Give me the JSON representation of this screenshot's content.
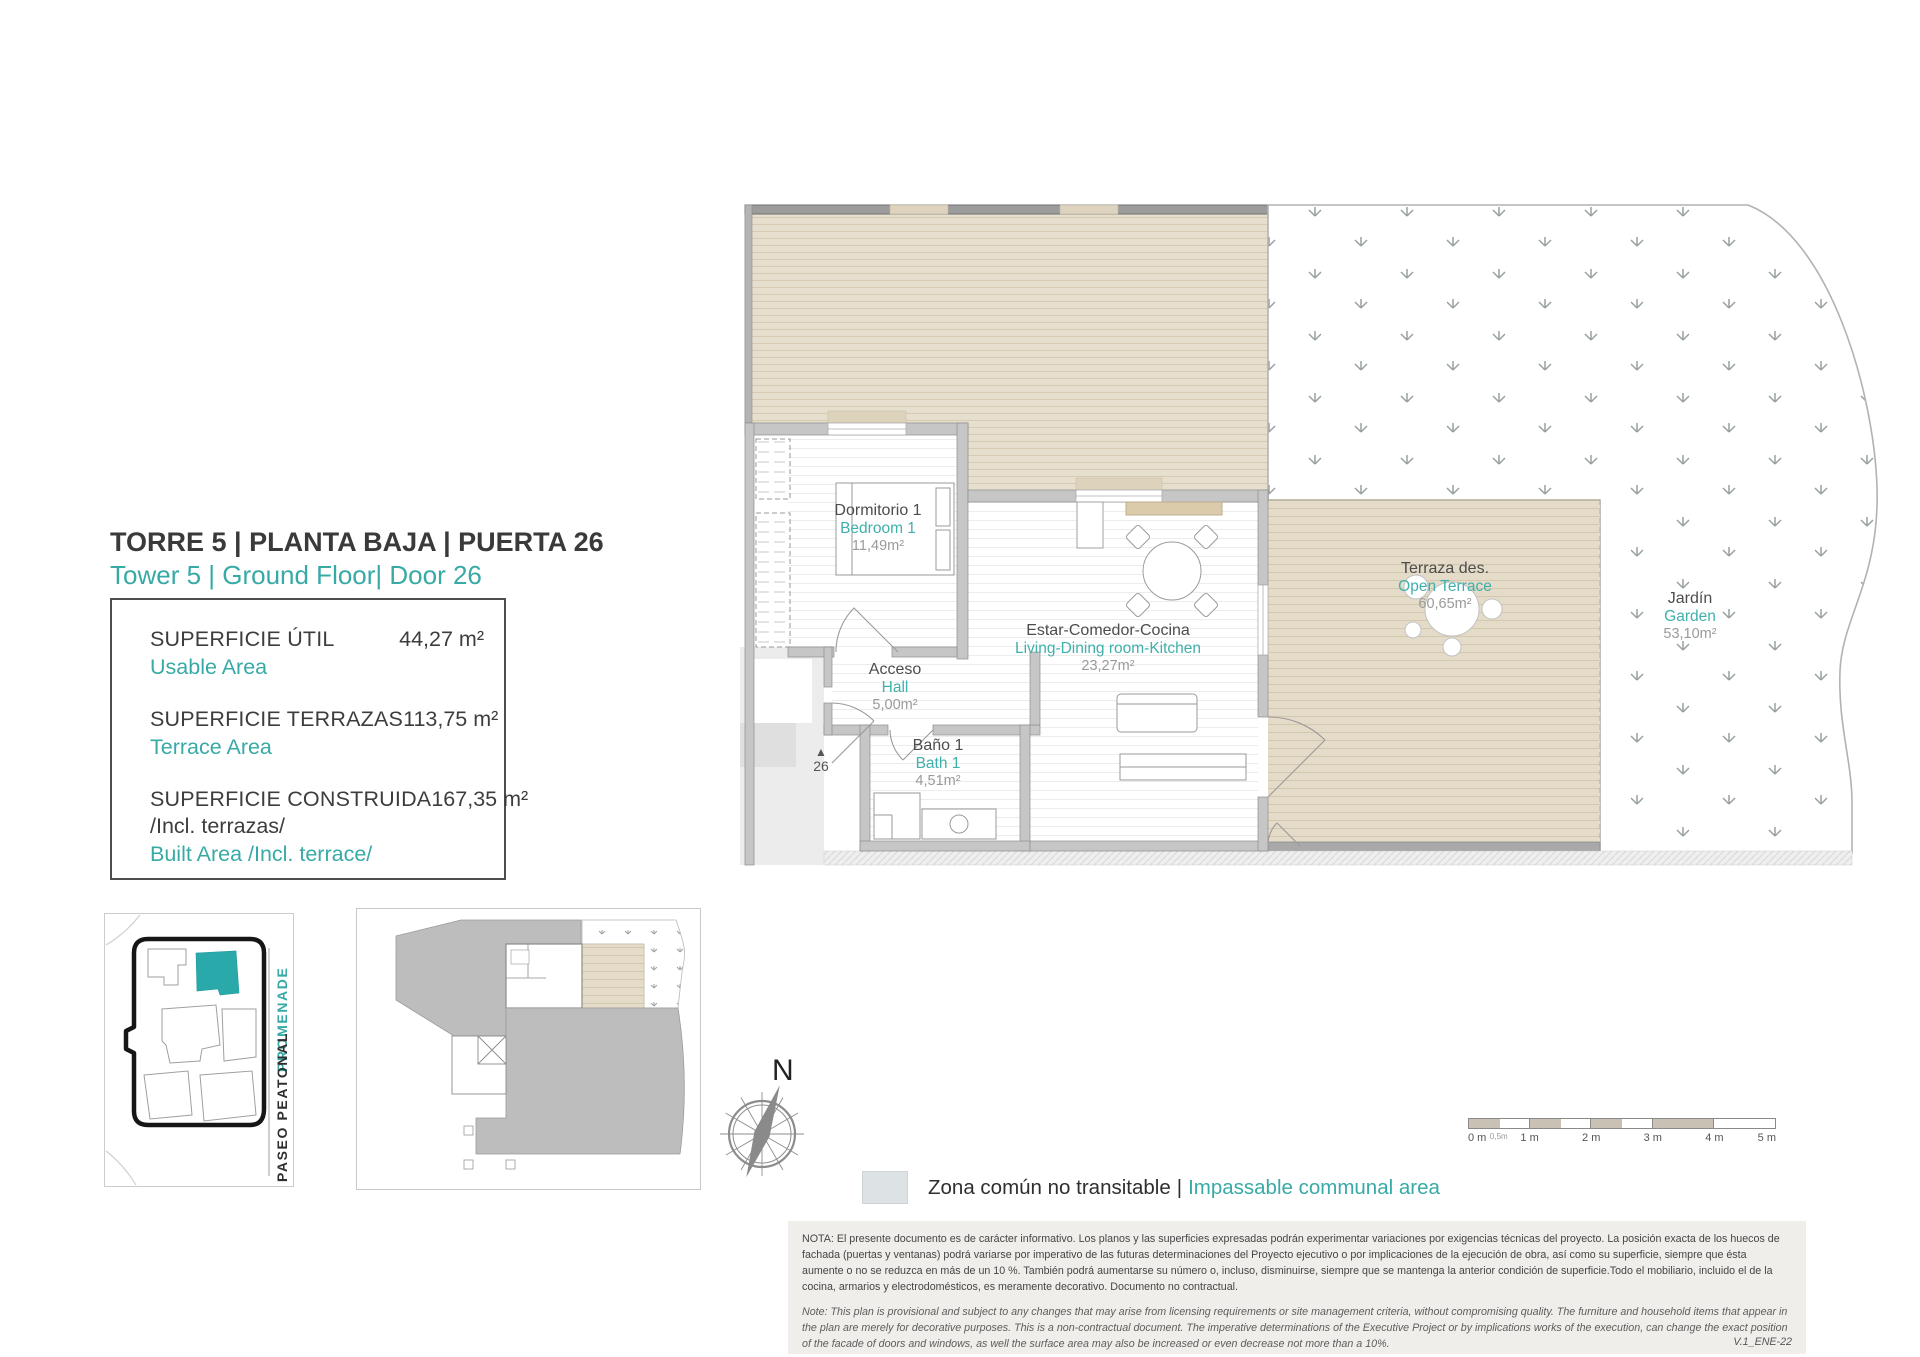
{
  "header": {
    "title_es": "TORRE 5 | PLANTA BAJA | PUERTA 26",
    "title_en": "Tower 5 | Ground Floor| Door 26"
  },
  "area_box": {
    "rows": [
      {
        "label_es": "SUPERFICIE ÚTIL",
        "label_en": "Usable Area",
        "value": "44,27 m²"
      },
      {
        "label_es": "SUPERFICIE TERRAZAS",
        "label_en": "Terrace Area",
        "value": "113,75 m²"
      },
      {
        "label_es": "SUPERFICIE CONSTRUIDA",
        "label_es_sub": "/Incl. terrazas/",
        "label_en": "Built Area /Incl. terrace/",
        "value": "167,35 m²"
      }
    ]
  },
  "rooms": [
    {
      "es": "Dormitorio 1",
      "en": "Bedroom 1",
      "area": "11,49m²"
    },
    {
      "es": "Estar-Comedor-Cocina",
      "en": "Living-Dining room-Kitchen",
      "area": "23,27m²"
    },
    {
      "es": "Acceso",
      "en": "Hall",
      "area": "5,00m²"
    },
    {
      "es": "Baño 1",
      "en": "Bath 1",
      "area": "4,51m²"
    },
    {
      "es": "Terraza des.",
      "en": "Open Terrace",
      "area": "60,65m²"
    },
    {
      "es": "Jardín",
      "en": "Garden",
      "area": "53,10m²"
    }
  ],
  "entrance": {
    "symbol": "▲",
    "number": "26"
  },
  "compass": {
    "label": "N"
  },
  "site_plan": {
    "promenade": "PROMENADE",
    "paseo_peatonal": "PASEO PEATONAL"
  },
  "scale_bar": {
    "labels": [
      "0 m",
      "0,5m",
      "1 m",
      "2 m",
      "3 m",
      "4 m",
      "5 m"
    ]
  },
  "legend": {
    "label_es": "Zona común no transitable",
    "separator": "|",
    "label_en": "Impassable communal area",
    "swatch_color": "#dde3e5"
  },
  "notes": {
    "es": "NOTA: El presente documento es de carácter informativo. Los planos y las superficies expresadas podrán experimentar variaciones por exigencias técnicas del proyecto. La posición exacta de los huecos de fachada (puertas y ventanas) podrá variarse por imperativo de las futuras determinaciones del Proyecto ejecutivo o por implicaciones de la ejecución de obra, así como su superficie, siempre que ésta aumente o no se reduzca en más de un 10 %. También podrá aumentarse su número o, incluso, disminuirse, siempre que se mantenga la anterior condición de superficie.Todo el mobiliario, incluido el de la cocina, armarios y electrodomésticos, es meramente decorativo. Documento no contractual.",
    "en": "Note: This plan is provisional and subject to any changes that may arise from licensing requirements or site management criteria, without compromising quality. The furniture and household items that appear in the plan are merely for decorative purposes. This is a non-contractual document. The imperative determinations of the Executive Project or by implications works of the execution, can change the exact position of the facade of doors and windows, as well the surface area may also be increased or even decrease not more than a 10%.",
    "version": "V.1_ENE-22"
  },
  "colors": {
    "accent": "#38aaa6",
    "highlight_building": "#2aa9ab",
    "deck_beige": "#e6ddcc",
    "terrace_beige": "#e4dbc9",
    "wall_gray": "#c6c6c6",
    "note_bg": "#efeeeb"
  }
}
